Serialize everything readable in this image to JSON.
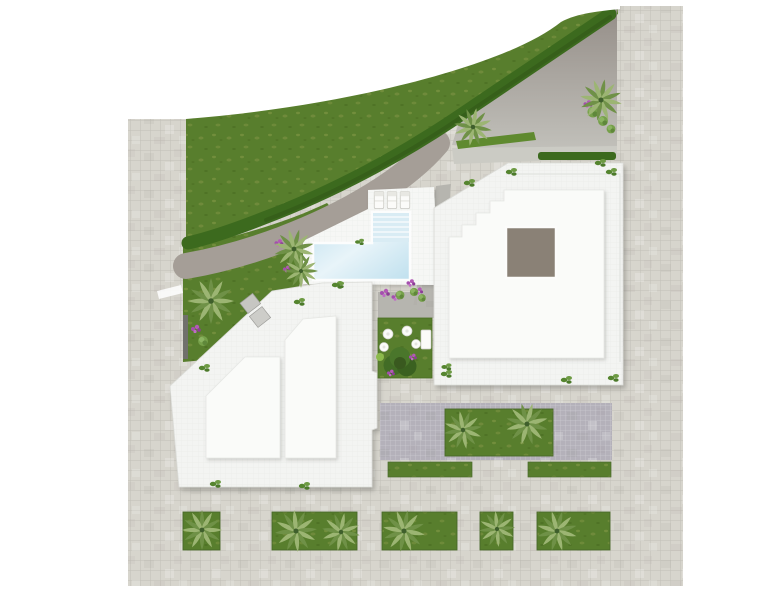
{
  "scene": {
    "title": "Residential site plan — top-down 3D render",
    "description": "Top-down architectural rendering of a residential plot: two white flat-roof buildings, an L-shaped swimming pool with three sun loungers, a large lawn bounded by a curved dark hedge, a taupe driveway, a paved parking court with planters, palm trees in rectangular street planters and light tiled sidewalks framing the site.",
    "width_px": 780,
    "height_px": 600
  },
  "colors": {
    "background": "#ffffff",
    "paving": "#d7d5cd",
    "paving_line": "#c2c0b6",
    "grass": "#587e2d",
    "grass_fleck": "#8c9a4b",
    "garden_grass": "#5f8a2f",
    "planter_grass": "#4f7729",
    "hedge": "#3c6a1e",
    "driveway_top": "#948d87",
    "driveway_bottom": "#c2c1bb",
    "garden_path": "#a59e97",
    "walkway": "#b6b5af",
    "parking": "#b4b1ba",
    "pool_water": "#bfe0ee",
    "pool_water_light": "#e8f4f9",
    "pool_steps": "#d9ecf4",
    "deck": "#f6f7f5",
    "roof_outer": "#f3f4f2",
    "roof_inner": "#fafbf9",
    "roof_edge": "#dcddd9",
    "skylight": "#8a8176",
    "planter_border": "#49682a",
    "palm_light": "#9cb573",
    "palm_dark": "#6f9147",
    "bush": "#76a04a",
    "flower": "#b25ab5",
    "wall_dark": "#70706b",
    "wall_box": "#c6c6c2",
    "furniture_white": "#fbfbf9"
  },
  "inventory": {
    "buildings": 2,
    "swimming_pools": 1,
    "sun_loungers": 3,
    "street_planters": 5,
    "parking_planters": 1,
    "palm_trees": 13,
    "round_courtyard_tables": 4,
    "courtyard_benches": 1,
    "skylights": 1,
    "hedges": 2,
    "lawns": 3
  }
}
